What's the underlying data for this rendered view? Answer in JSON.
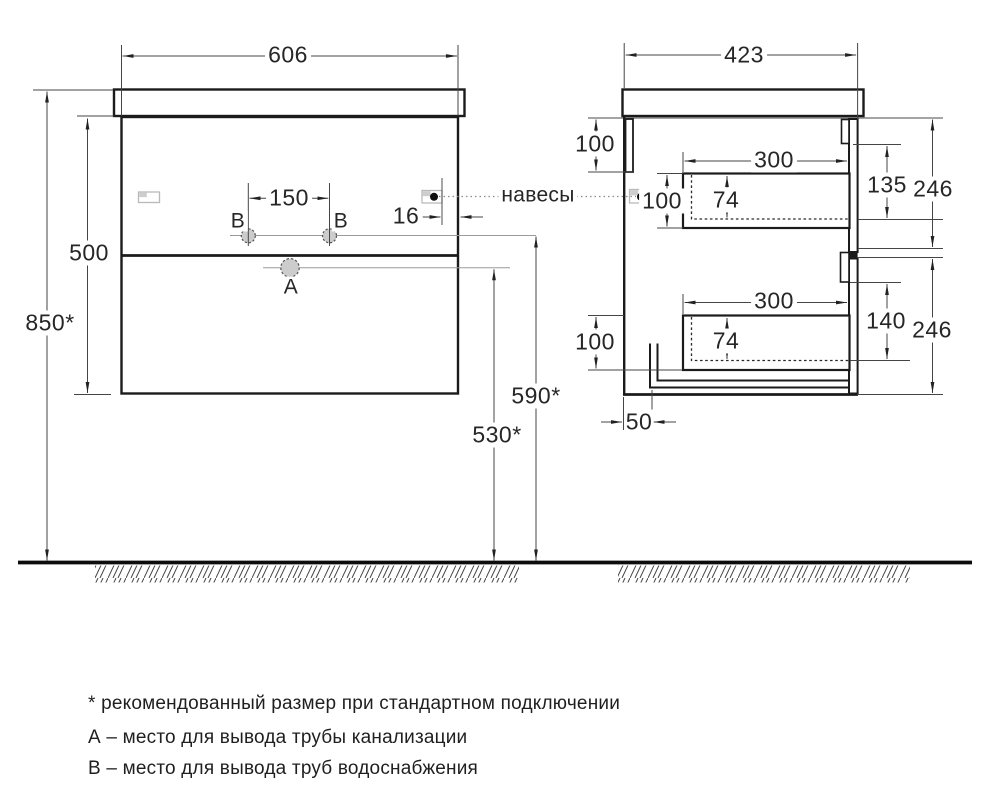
{
  "drawing_colors": {
    "object_line": "#1b1b1b",
    "dimension_line": "#454545",
    "thin_reference_line": "#9b9b9b",
    "hole_fill": "#cccccc",
    "background": "#ffffff"
  },
  "views": {
    "front": {
      "dims": {
        "width": "606",
        "overall_height": "850*",
        "cabinet_height": "500",
        "holes_spacing": "150",
        "hanger_inset": "16",
        "drain_height": "590*",
        "sewer_height": "530*"
      },
      "markers": {
        "supply_left": "В",
        "supply_right": "В",
        "drain": "А"
      }
    },
    "side": {
      "dims": {
        "depth": "423",
        "rail_height": "100",
        "upper_front_height": "100",
        "lower_front_height": "100",
        "upper_drawer_depth": "300",
        "lower_drawer_depth": "300",
        "upper_inner_height": "74",
        "lower_inner_height": "74",
        "upper_drop": "135",
        "upper_section": "246",
        "lower_drop": "140",
        "lower_section": "246",
        "pipe_offset": "50"
      }
    },
    "hangers_label": "навесы"
  },
  "notes": [
    "* рекомендованный размер при стандартном подключении",
    "А – место для вывода трубы канализации",
    "В – место для вывода труб водоснабжения"
  ]
}
